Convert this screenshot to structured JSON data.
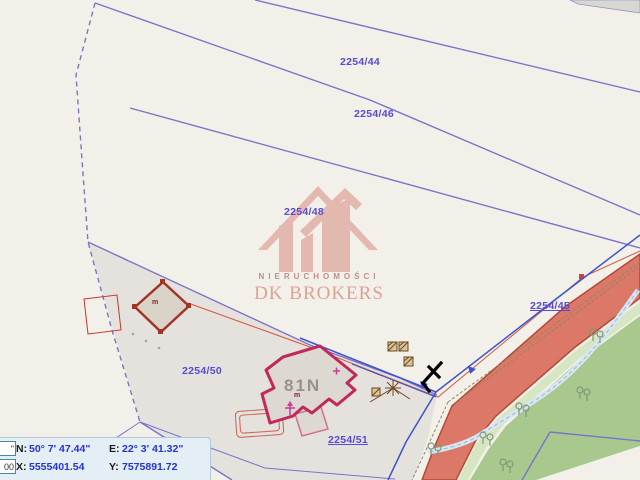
{
  "map": {
    "parcels": [
      {
        "label": "2254/44"
      },
      {
        "label": "2254/46"
      },
      {
        "label": "2254/48"
      },
      {
        "label": "2254/45"
      },
      {
        "label": "2254/50"
      },
      {
        "label": "2254/51"
      }
    ],
    "building_label": "81N",
    "small_building_symbol": "m",
    "main_building_symbol": "m",
    "watermark": {
      "subtitle": "NIERUCHOMOŚCI",
      "title": "DK BROKERS"
    },
    "colors": {
      "parcel_label": "#574bd1",
      "boundary_purple": "#7b74c9",
      "road_fill": "#db7867",
      "road_border": "#b44b38",
      "green_area": "#a9c88e",
      "building_border": "#bf2a5a",
      "utility_blue": "#3d55cc",
      "watermark_red": "#c0392b"
    }
  },
  "statusbar": {
    "field1_value": "\"",
    "field2_value": "00",
    "n_label": "N:",
    "n_value": "50° 7' 47.44\"",
    "e_label": "E:",
    "e_value": "22° 3' 41.32\"",
    "x_label": "X:",
    "x_value": "5555401.54",
    "y_label": "Y:",
    "y_value": "7575891.72"
  }
}
